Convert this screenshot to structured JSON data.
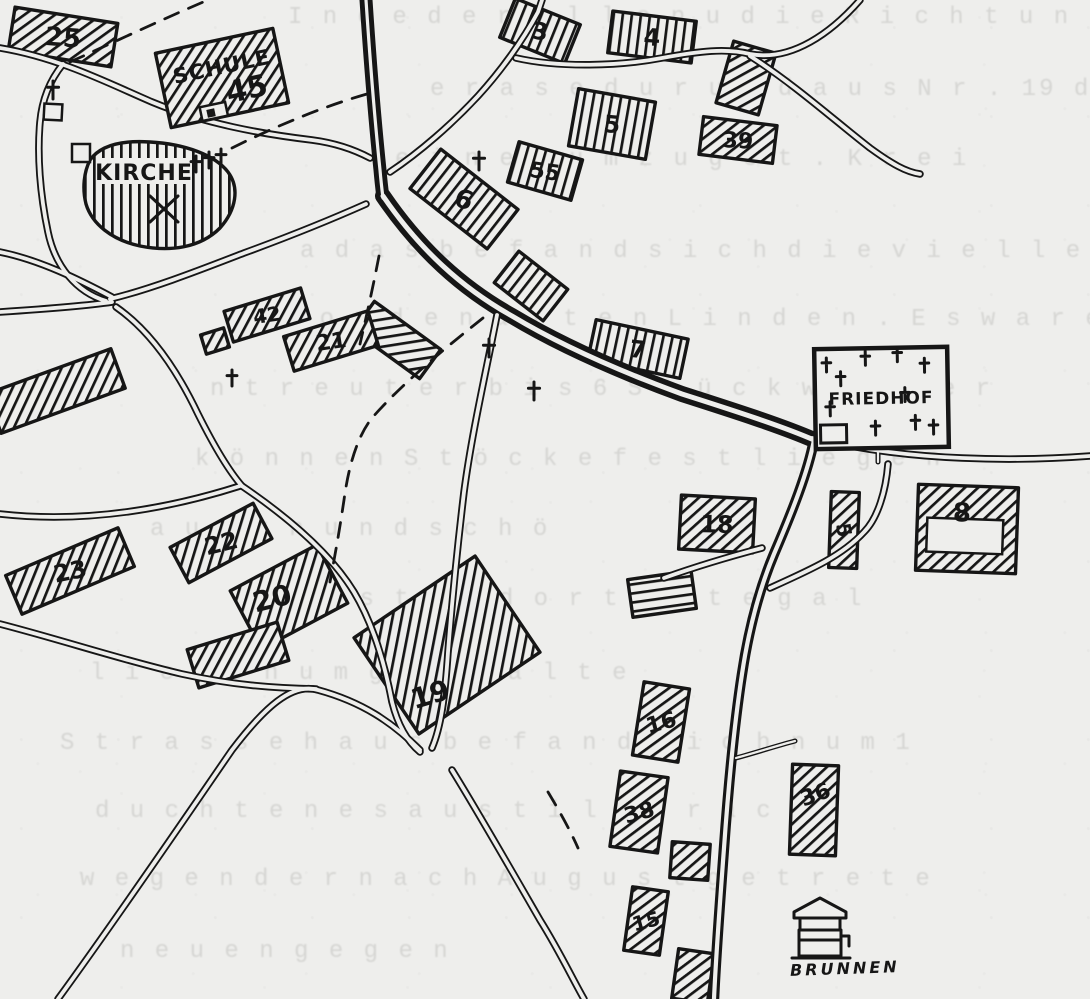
{
  "map": {
    "paper_color": "#eeeeec",
    "ink_color": "#161616",
    "landmarks": {
      "schule": {
        "label": "SCHULE",
        "number": "45"
      },
      "kirche": {
        "label": "KIRCHE"
      },
      "friedhof": {
        "label": "FRIEDHOF"
      },
      "brunnen": {
        "label": "BRUNNEN"
      }
    },
    "buildings": [
      {
        "label": "25",
        "cx": 63,
        "cy": 37,
        "w": 104,
        "h": 44,
        "rot": 9,
        "hatch": "d",
        "lsize": 26
      },
      {
        "label": "3",
        "cx": 540,
        "cy": 31,
        "w": 70,
        "h": 42,
        "rot": 22,
        "hatch": "v",
        "lsize": 24
      },
      {
        "label": "4",
        "cx": 652,
        "cy": 37,
        "w": 84,
        "h": 42,
        "rot": 7,
        "hatch": "v",
        "lsize": 24
      },
      {
        "label": "",
        "cx": 746,
        "cy": 78,
        "w": 44,
        "h": 64,
        "rot": 16,
        "hatch": "d"
      },
      {
        "label": "5",
        "cx": 612,
        "cy": 124,
        "w": 78,
        "h": 58,
        "rot": 10,
        "hatch": "v",
        "lsize": 24
      },
      {
        "label": "39",
        "cx": 738,
        "cy": 140,
        "w": 74,
        "h": 38,
        "rot": 7,
        "hatch": "d",
        "lsize": 22
      },
      {
        "label": "55",
        "cx": 545,
        "cy": 171,
        "w": 66,
        "h": 42,
        "rot": 16,
        "hatch": "v",
        "lsize": 22
      },
      {
        "label": "6",
        "cx": 464,
        "cy": 199,
        "w": 98,
        "h": 50,
        "rot": 38,
        "hatch": "v",
        "lsize": 26
      },
      {
        "label": "",
        "cx": 531,
        "cy": 286,
        "w": 62,
        "h": 40,
        "rot": 38,
        "hatch": "v"
      },
      {
        "label": "",
        "cx": 397,
        "cy": 340,
        "w": 82,
        "h": 36,
        "rot": 36,
        "hatch": "d"
      },
      {
        "label": "42",
        "cx": 267,
        "cy": 315,
        "w": 80,
        "h": 32,
        "rot": -17,
        "hatch": "d",
        "lsize": 20
      },
      {
        "label": "",
        "cx": 215,
        "cy": 341,
        "w": 24,
        "h": 20,
        "rot": -17,
        "hatch": "d"
      },
      {
        "label": "21",
        "cx": 331,
        "cy": 341,
        "w": 88,
        "h": 36,
        "rot": -17,
        "hatch": "d",
        "lsize": 22
      },
      {
        "label": "",
        "cx": 56,
        "cy": 391,
        "w": 132,
        "h": 42,
        "rot": -20,
        "hatch": "d"
      },
      {
        "label": "7",
        "cx": 638,
        "cy": 349,
        "w": 94,
        "h": 40,
        "rot": 12,
        "hatch": "v",
        "lsize": 24
      },
      {
        "label": "23",
        "cx": 70,
        "cy": 571,
        "w": 122,
        "h": 42,
        "rot": -23,
        "hatch": "d",
        "lsize": 24
      },
      {
        "label": "22",
        "cx": 221,
        "cy": 543,
        "w": 94,
        "h": 40,
        "rot": -28,
        "hatch": "d",
        "lsize": 24
      },
      {
        "label": "20",
        "cx": 289,
        "cy": 597,
        "w": 98,
        "h": 66,
        "rot": -28,
        "hatch": "d",
        "lsize": 28,
        "lx": 272,
        "ly": 598
      },
      {
        "label": "",
        "cx": 238,
        "cy": 655,
        "w": 94,
        "h": 40,
        "rot": -17,
        "hatch": "d"
      },
      {
        "label": "19",
        "cx": 447,
        "cy": 645,
        "w": 146,
        "h": 116,
        "rot": -34,
        "hatch": "d",
        "lsize": 28,
        "lx": 430,
        "ly": 694
      },
      {
        "label": "18",
        "cx": 717,
        "cy": 524,
        "w": 74,
        "h": 54,
        "rot": 3,
        "hatch": "d",
        "lsize": 24
      },
      {
        "label": "",
        "cx": 662,
        "cy": 594,
        "w": 64,
        "h": 38,
        "rot": -8,
        "hatch": "h"
      },
      {
        "label": "5",
        "cx": 844,
        "cy": 530,
        "w": 28,
        "h": 76,
        "rot": 2,
        "hatch": "d",
        "lsize": 20,
        "lrot": 80
      },
      {
        "label": "8",
        "cx": 967,
        "cy": 529,
        "w": 100,
        "h": 86,
        "rot": 2,
        "hatch": "d",
        "lsize": 26,
        "lx": 962,
        "ly": 512,
        "hollow": true
      },
      {
        "label": "16",
        "cx": 661,
        "cy": 722,
        "w": 46,
        "h": 74,
        "rot": 9,
        "hatch": "d",
        "lsize": 22,
        "lrot": -15
      },
      {
        "label": "38",
        "cx": 639,
        "cy": 812,
        "w": 48,
        "h": 76,
        "rot": 8,
        "hatch": "d",
        "lsize": 22,
        "lrot": -15
      },
      {
        "label": "",
        "cx": 690,
        "cy": 861,
        "w": 38,
        "h": 36,
        "rot": 4,
        "hatch": "d"
      },
      {
        "label": "15",
        "cx": 646,
        "cy": 921,
        "w": 36,
        "h": 64,
        "rot": 8,
        "hatch": "d",
        "lsize": 20,
        "lrot": -15
      },
      {
        "label": "",
        "cx": 693,
        "cy": 976,
        "w": 36,
        "h": 50,
        "rot": 8,
        "hatch": "d"
      },
      {
        "label": "36",
        "cx": 814,
        "cy": 810,
        "w": 46,
        "h": 90,
        "rot": 2,
        "hatch": "d",
        "lsize": 22,
        "lrot": -20,
        "lx": 815,
        "ly": 794
      }
    ],
    "crosses": [
      {
        "x": 53,
        "y": 90,
        "s": 9
      },
      {
        "x": 479,
        "y": 161,
        "s": 9
      },
      {
        "x": 489,
        "y": 348,
        "s": 9
      },
      {
        "x": 534,
        "y": 391,
        "s": 9
      },
      {
        "x": 232,
        "y": 378,
        "s": 8
      },
      {
        "x": 196,
        "y": 164,
        "s": 8
      },
      {
        "x": 209,
        "y": 160,
        "s": 8
      },
      {
        "x": 221,
        "y": 157,
        "s": 8
      }
    ],
    "friedhof_crosses": [
      {
        "x": 827,
        "y": 364
      },
      {
        "x": 841,
        "y": 378
      },
      {
        "x": 866,
        "y": 358
      },
      {
        "x": 898,
        "y": 355
      },
      {
        "x": 925,
        "y": 366
      },
      {
        "x": 830,
        "y": 408
      },
      {
        "x": 875,
        "y": 428
      },
      {
        "x": 915,
        "y": 423
      },
      {
        "x": 933,
        "y": 428
      },
      {
        "x": 905,
        "y": 395
      }
    ]
  },
  "ghost_text": {
    "lines": [
      {
        "y": 4,
        "x": 288,
        "text": "I n d e  d e r  o l l e n  u   d i e  R i c h t u n"
      },
      {
        "y": 76,
        "x": 430,
        "text": "e r a s e  d u r   u n d  a u s  N r .  19  d e"
      },
      {
        "y": 146,
        "x": 395,
        "text": "e i  n e u  u m  z u   g e t .  K r e i"
      },
      {
        "y": 238,
        "x": 300,
        "text": "a  d a s  b e f a n d  s i c h  d i e  v i e l l e i c h"
      },
      {
        "y": 306,
        "x": 250,
        "text": "n  v o n  d e n  a l t e n  L i n d e n .  E s  w a r e n"
      },
      {
        "y": 376,
        "x": 210,
        "text": "n t r e u t e r  b i s  6  S t ü c k  w i e d e r"
      },
      {
        "y": 446,
        "x": 195,
        "text": "k ö n n e n  S t ö c k e  f e s t l i e g e n"
      },
      {
        "y": 516,
        "x": 150,
        "text": "a u e r n  u n d  s c h ö"
      },
      {
        "y": 586,
        "x": 290,
        "text": "e r s t e n  d o r t  i s t  e g a l"
      },
      {
        "y": 660,
        "x": 90,
        "text": "l i e b e n  u m g e s t a l t e"
      },
      {
        "y": 730,
        "x": 60,
        "text": "S t r a s s e  h a u s  b e f a n d  s i c h  n u m  1"
      },
      {
        "y": 798,
        "x": 95,
        "text": "d u c h t e n  e s  a u  s t i l l  F r a c h"
      },
      {
        "y": 866,
        "x": 80,
        "text": "w e g e n  d e r  n a c h  A u g u s t  g e t r e t e"
      },
      {
        "y": 938,
        "x": 120,
        "text": "n e u e n  g e g e n"
      }
    ]
  }
}
